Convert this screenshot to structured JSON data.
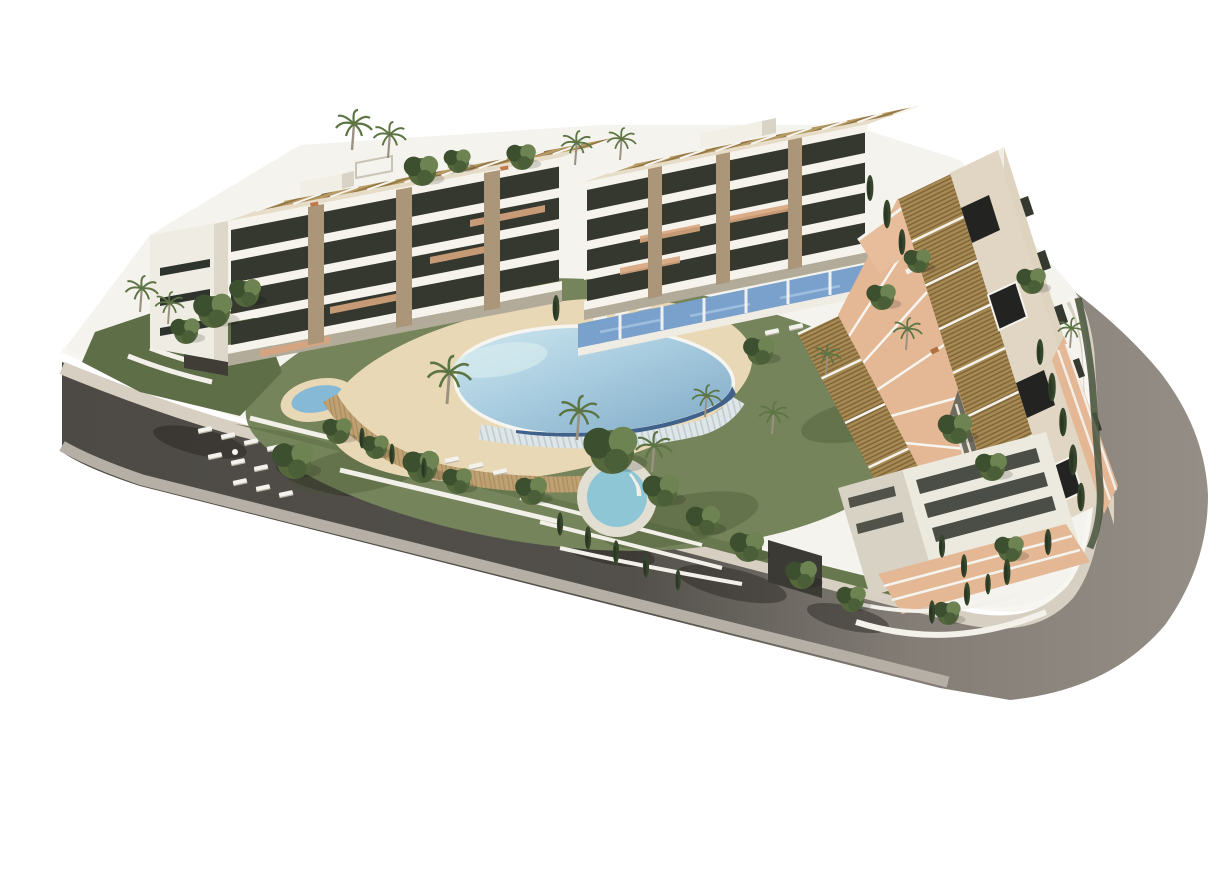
{
  "meta": {
    "type": "architectural-3d-render",
    "view": "aerial isometric",
    "subject": "modern apartment complex with central lagoon pool and perimeter road",
    "background": "#ffffff"
  },
  "palette": {
    "site_base": "#f4f3ee",
    "asphalt_dark": "#53504b",
    "asphalt_light": "#948e86",
    "sidewalk_inner": "#d6cfc2",
    "sidewalk_outer": "#b5afa5",
    "boundary_wall": "#f7f6f1",
    "grass": "#75845a",
    "grass_dark": "#5e6e47",
    "sand": "#e9d8b5",
    "stone_wall": "#bfa274",
    "overflow_edge": "#dfe6e8",
    "pool_light": "#cfe7ef",
    "pool_mid": "#a9cde0",
    "pool_deep": "#7fa9c6",
    "swim_lane": "#40618a",
    "jacuzzi_water": "#8ec6d6",
    "pond_water": "#85b9d6",
    "slab_white": "#f6f3ec",
    "glass_dark": "#34382f",
    "facade_white": "#efece3",
    "facade_shade": "#ddd8c9",
    "plinth": "#b3ab9a",
    "stone_pier": "#ab967a",
    "roof_terrace": "#e6dcc7",
    "pergola_tan": "#b99c63",
    "pergola_line": "#8a6f42",
    "louver_tan": "#a88b54",
    "louver_line": "#7c6136",
    "flat_roof": "#e0d6c3",
    "roof_hatch": "#232322",
    "terracotta": "#d8a57e",
    "salmon_terrace": "#e4b795",
    "blue_terrace": "#7aa0cc",
    "dark_facade": "#6f6b5f",
    "tree_green": "#55683d",
    "tree_light": "#6e8352",
    "tree_dark": "#3c4f2e",
    "cypress": "#35462c",
    "palm_trunk": "#9a9181",
    "palm_frond": "#5d7444",
    "lounger": "#f4f2ec",
    "shadow": "#26231f"
  },
  "scene": {
    "road": {
      "kind": "curved perimeter road",
      "surfaces": [
        "dark asphalt (south-west leg)",
        "light asphalt (east leg)",
        "inner sidewalk",
        "outer sidewalk"
      ],
      "details": [
        "tree shadows on asphalt",
        "driveway cut"
      ]
    },
    "buildings": [
      {
        "id": "west-block",
        "floors": 4,
        "features": [
          "white gable end",
          "glass balcony bands",
          "stone-clad piers",
          "rooftop pergolas",
          "roof terraces",
          "garage entrance"
        ]
      },
      {
        "id": "north-block",
        "floors": 4,
        "features": [
          "rooftop pergolas",
          "roof access box",
          "stone-clad piers",
          "blue ground-floor terraces"
        ]
      },
      {
        "id": "east-block",
        "floors": 4,
        "features": [
          "long louvered pergola roof",
          "flat roof with dark hatches",
          "terracotta podium terraces",
          "corner block",
          "roadside fence"
        ]
      }
    ],
    "amenities": [
      "lagoon pool with dark swim lane",
      "infinity overflow edge",
      "sand beach deck",
      "round jacuzzi",
      "small garden pond",
      "sun loungers",
      "shade canopies",
      "lawns",
      "palm trees",
      "cypress trees",
      "shrub trees"
    ]
  }
}
